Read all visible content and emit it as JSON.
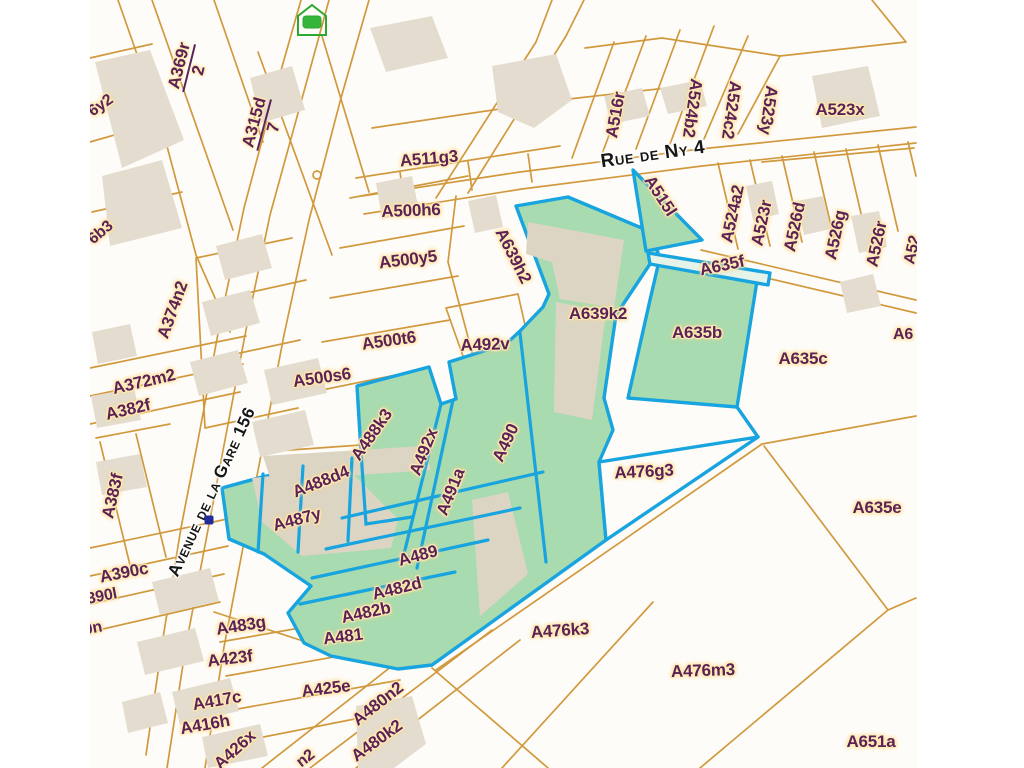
{
  "map": {
    "colors": {
      "background": "#fefcf8",
      "parcel_line": "#cf9434",
      "building_fill": "#e4ddcf",
      "selected_fill": "#a8dbb0",
      "selected_border": "#18a4df",
      "parcel_label": "#5c2156",
      "label_halo": "#ffe9ab",
      "street_label": "#161616",
      "point_marker": "#232b9b",
      "home_icon": "#2fa832"
    },
    "street_labels": [
      {
        "text": "Avenue de la Gare 156",
        "x": 212,
        "y": 492,
        "rot": -65,
        "size": 17
      },
      {
        "text": "Rue de Ny 4",
        "x": 653,
        "y": 155,
        "rot": -8,
        "size": 19
      }
    ],
    "fraction_labels": [
      {
        "num": "A369r",
        "den": "2",
        "x": 189,
        "y": 68,
        "rot": -76
      },
      {
        "num": "A315d",
        "den": "7",
        "x": 264,
        "y": 125,
        "rot": -75
      }
    ],
    "labels": [
      {
        "text": "6y2",
        "x": 101,
        "y": 106,
        "rot": -35,
        "size": 16,
        "partial": true
      },
      {
        "text": "6b3",
        "x": 101,
        "y": 233,
        "rot": -40,
        "size": 16,
        "partial": true
      },
      {
        "text": "A374n2",
        "x": 173,
        "y": 310,
        "rot": -70
      },
      {
        "text": "A372m2",
        "x": 144,
        "y": 382,
        "rot": -13
      },
      {
        "text": "A382f",
        "x": 128,
        "y": 410,
        "rot": -13
      },
      {
        "text": "A383f",
        "x": 113,
        "y": 496,
        "rot": -77
      },
      {
        "text": "A390c",
        "x": 124,
        "y": 573,
        "rot": -11
      },
      {
        "text": "390l",
        "x": 102,
        "y": 597,
        "rot": -11,
        "size": 16,
        "partial": true
      },
      {
        "text": "0n",
        "x": 93,
        "y": 629,
        "rot": -11,
        "size": 16,
        "partial": true
      },
      {
        "text": "A511g3",
        "x": 429,
        "y": 159,
        "rot": -5
      },
      {
        "text": "A500h6",
        "x": 411,
        "y": 211,
        "rot": -2
      },
      {
        "text": "A500y5",
        "x": 408,
        "y": 260,
        "rot": -7
      },
      {
        "text": "A500t6",
        "x": 389,
        "y": 341,
        "rot": -8
      },
      {
        "text": "A500s6",
        "x": 322,
        "y": 378,
        "rot": -8
      },
      {
        "text": "A492v",
        "x": 485,
        "y": 345,
        "rot": -2
      },
      {
        "text": "A639h2",
        "x": 513,
        "y": 256,
        "rot": 63
      },
      {
        "text": "A515l",
        "x": 660,
        "y": 196,
        "rot": 57
      },
      {
        "text": "A516r",
        "x": 616,
        "y": 115,
        "rot": -80
      },
      {
        "text": "A524b2",
        "x": 692,
        "y": 108,
        "rot": 98
      },
      {
        "text": "A524c2",
        "x": 731,
        "y": 110,
        "rot": 98
      },
      {
        "text": "A523y",
        "x": 768,
        "y": 110,
        "rot": 98
      },
      {
        "text": "A523x",
        "x": 840,
        "y": 110,
        "rot": 0
      },
      {
        "text": "A524a2",
        "x": 733,
        "y": 214,
        "rot": -78
      },
      {
        "text": "A523r",
        "x": 762,
        "y": 223,
        "rot": -78
      },
      {
        "text": "A526d",
        "x": 795,
        "y": 227,
        "rot": -78
      },
      {
        "text": "A526g",
        "x": 836,
        "y": 235,
        "rot": -78
      },
      {
        "text": "A526r",
        "x": 877,
        "y": 244,
        "rot": -78
      },
      {
        "text": "A52",
        "x": 913,
        "y": 250,
        "rot": -78,
        "size": 16,
        "partial": true
      },
      {
        "text": "A635f",
        "x": 722,
        "y": 266,
        "rot": -12
      },
      {
        "text": "A635b",
        "x": 697,
        "y": 333,
        "rot": 0
      },
      {
        "text": "A635c",
        "x": 803,
        "y": 359,
        "rot": 0
      },
      {
        "text": "A6",
        "x": 903,
        "y": 335,
        "rot": 0,
        "size": 16,
        "partial": true
      },
      {
        "text": "A639k2",
        "x": 598,
        "y": 314,
        "rot": 0
      },
      {
        "text": "A488k3",
        "x": 372,
        "y": 435,
        "rot": -55
      },
      {
        "text": "A492x",
        "x": 424,
        "y": 452,
        "rot": -68
      },
      {
        "text": "A491a",
        "x": 451,
        "y": 492,
        "rot": -68
      },
      {
        "text": "A490",
        "x": 506,
        "y": 443,
        "rot": -65
      },
      {
        "text": "A488d4",
        "x": 321,
        "y": 482,
        "rot": -22
      },
      {
        "text": "A487y",
        "x": 297,
        "y": 520,
        "rot": -15
      },
      {
        "text": "A489",
        "x": 418,
        "y": 556,
        "rot": -15
      },
      {
        "text": "A482d",
        "x": 397,
        "y": 589,
        "rot": -14
      },
      {
        "text": "A482b",
        "x": 366,
        "y": 613,
        "rot": -12
      },
      {
        "text": "A481",
        "x": 343,
        "y": 637,
        "rot": -7
      },
      {
        "text": "A483g",
        "x": 241,
        "y": 626,
        "rot": -9
      },
      {
        "text": "A423f",
        "x": 230,
        "y": 659,
        "rot": -7
      },
      {
        "text": "A425e",
        "x": 326,
        "y": 689,
        "rot": -7
      },
      {
        "text": "A417c",
        "x": 217,
        "y": 701,
        "rot": -10
      },
      {
        "text": "A416h",
        "x": 205,
        "y": 725,
        "rot": -10
      },
      {
        "text": "A426x",
        "x": 235,
        "y": 750,
        "rot": -42
      },
      {
        "text": "A480n2",
        "x": 378,
        "y": 704,
        "rot": -38
      },
      {
        "text": "A480k2",
        "x": 377,
        "y": 741,
        "rot": -36
      },
      {
        "text": "n2",
        "x": 306,
        "y": 759,
        "rot": -38,
        "size": 16,
        "partial": true
      },
      {
        "text": "A476g3",
        "x": 644,
        "y": 472,
        "rot": -3
      },
      {
        "text": "A476k3",
        "x": 560,
        "y": 631,
        "rot": -4
      },
      {
        "text": "A635e",
        "x": 877,
        "y": 508,
        "rot": 0
      },
      {
        "text": "A476m3",
        "x": 703,
        "y": 671,
        "rot": -2
      },
      {
        "text": "A651a",
        "x": 871,
        "y": 742,
        "rot": 0
      }
    ],
    "selected_parcels": [
      "A515l",
      "A635f",
      "A635b",
      "A639h2",
      "A639k2",
      "A490",
      "A491a",
      "A492x",
      "A489",
      "A482d",
      "A482b",
      "A481",
      "A487y"
    ],
    "markers": [
      {
        "name": "selected-point-marker",
        "x": 209,
        "y": 520
      }
    ],
    "icons": [
      {
        "name": "home-marker-icon",
        "x": 295,
        "y": 2
      }
    ]
  }
}
